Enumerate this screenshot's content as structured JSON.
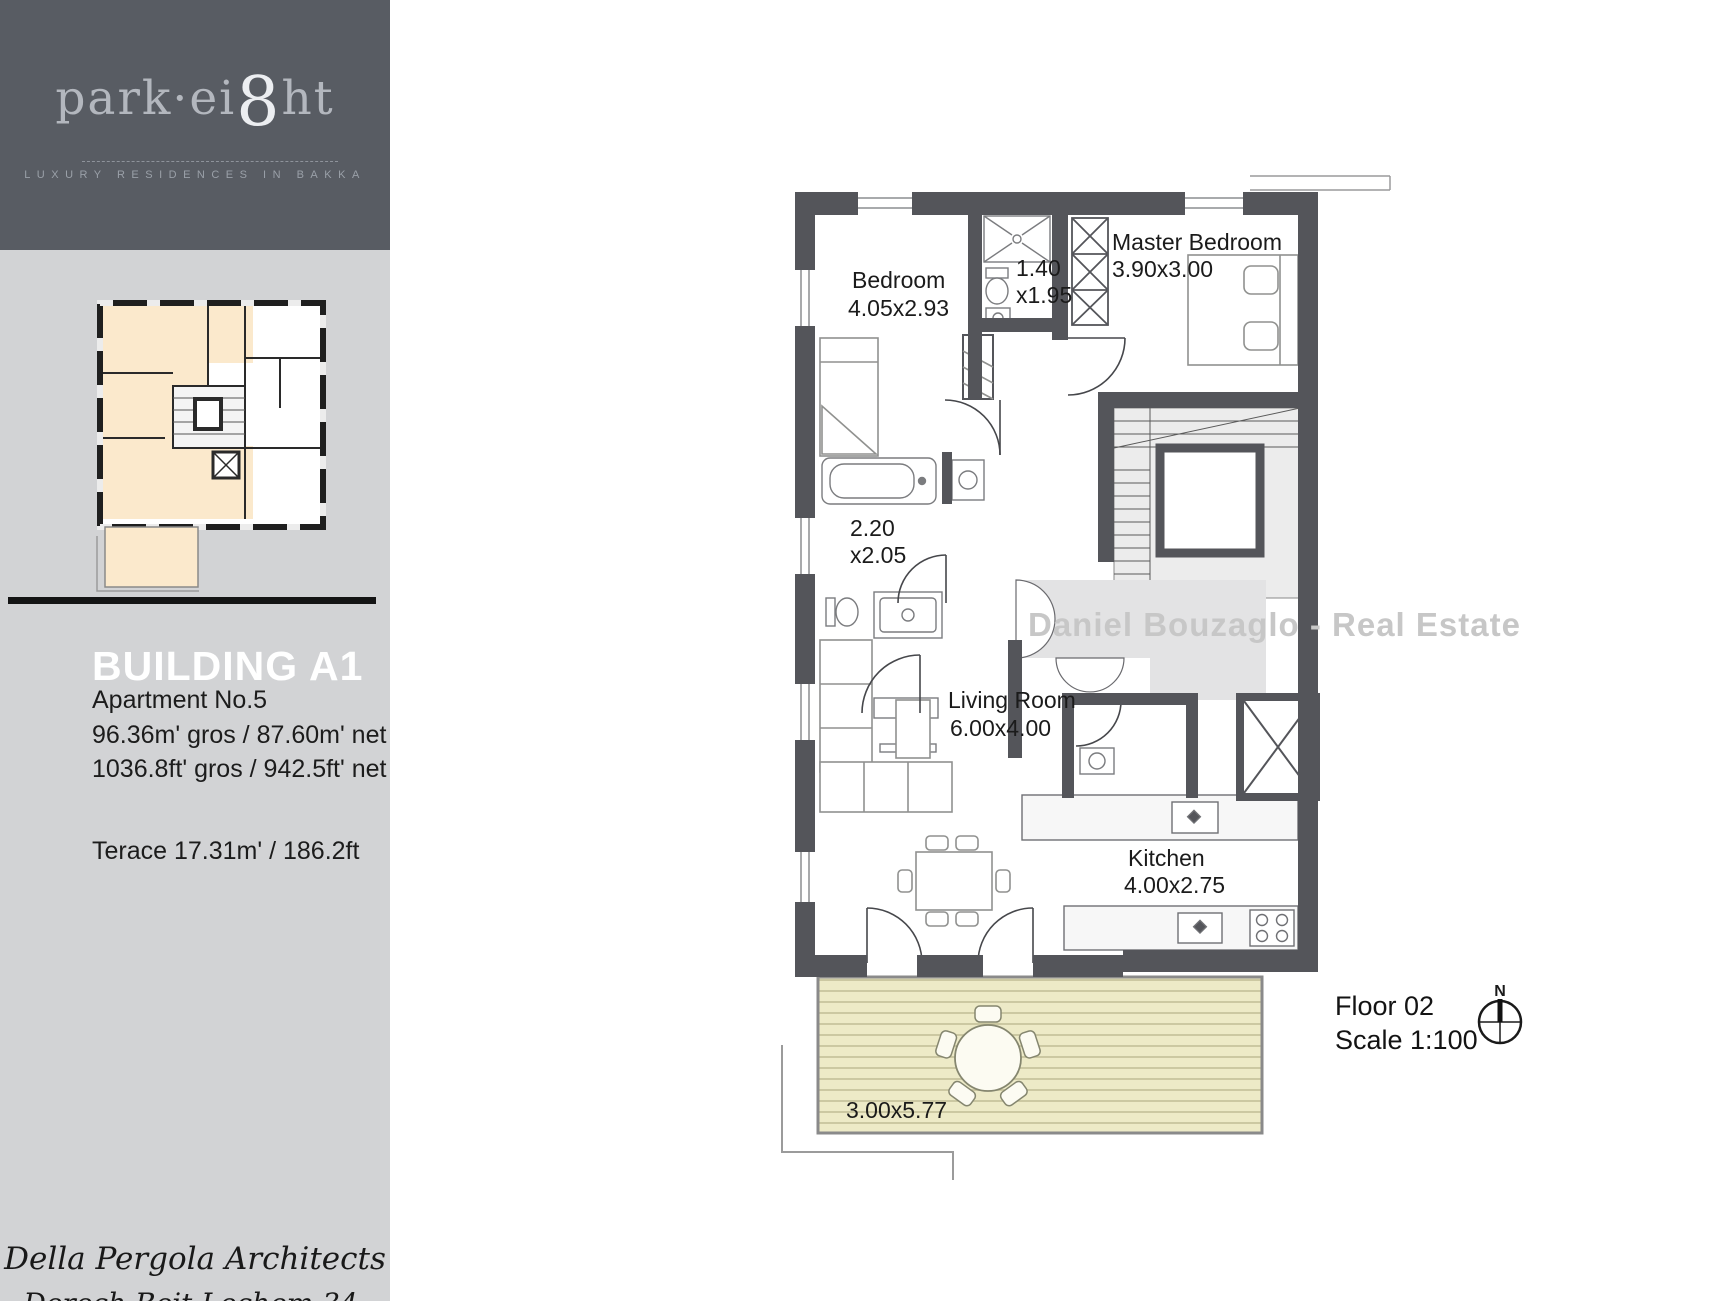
{
  "brand": {
    "logo": {
      "pre": "park",
      "dot": "·",
      "mid": "ei",
      "eight": "8",
      "post": "ht"
    },
    "tagline": "LUXURY RESIDENCES IN BAKKA"
  },
  "sidebar": {
    "building_title": "BUILDING A1",
    "apartment": "Apartment No.5",
    "area_metric": "96.36m' gros / 87.60m' net",
    "area_imperial": "1036.8ft' gros / 942.5ft' net",
    "terrace_line": "Terace 17.31m' / 186.2ft"
  },
  "architect": {
    "name": "Della Pergola Architects",
    "address": "Derech Beit Lechem 34, Jerusalem"
  },
  "watermark": "Daniel Bouzaglo - Real Estate",
  "plan_info": {
    "floor": "Floor 02",
    "scale": "Scale 1:100",
    "north_label": "N"
  },
  "rooms": {
    "bedroom": {
      "name": "Bedroom",
      "dims": "4.05x2.93"
    },
    "shower": {
      "dims_line1": "1.40",
      "dims_line2": "x1.95"
    },
    "master": {
      "name": "Master Bedroom",
      "dims": "3.90x3.00"
    },
    "bath": {
      "dims_line1": "2.20",
      "dims_line2": "x2.05"
    },
    "living": {
      "name": "Living Room",
      "dims": "6.00x4.00"
    },
    "kitchen": {
      "name": "Kitchen",
      "dims": "4.00x2.75"
    },
    "terrace": {
      "dims": "3.00x5.77"
    }
  },
  "colors": {
    "header_bg": "#585c63",
    "sidebar_bg": "#d2d3d5",
    "divider": "#141414",
    "wall": "#54555a",
    "hall_gray": "#e3e3e4",
    "deck": "#edeac7",
    "deck_stripe": "#c3bf98",
    "highlight_cream": "#fbe9cc",
    "watermark": "#c7c7c7"
  }
}
